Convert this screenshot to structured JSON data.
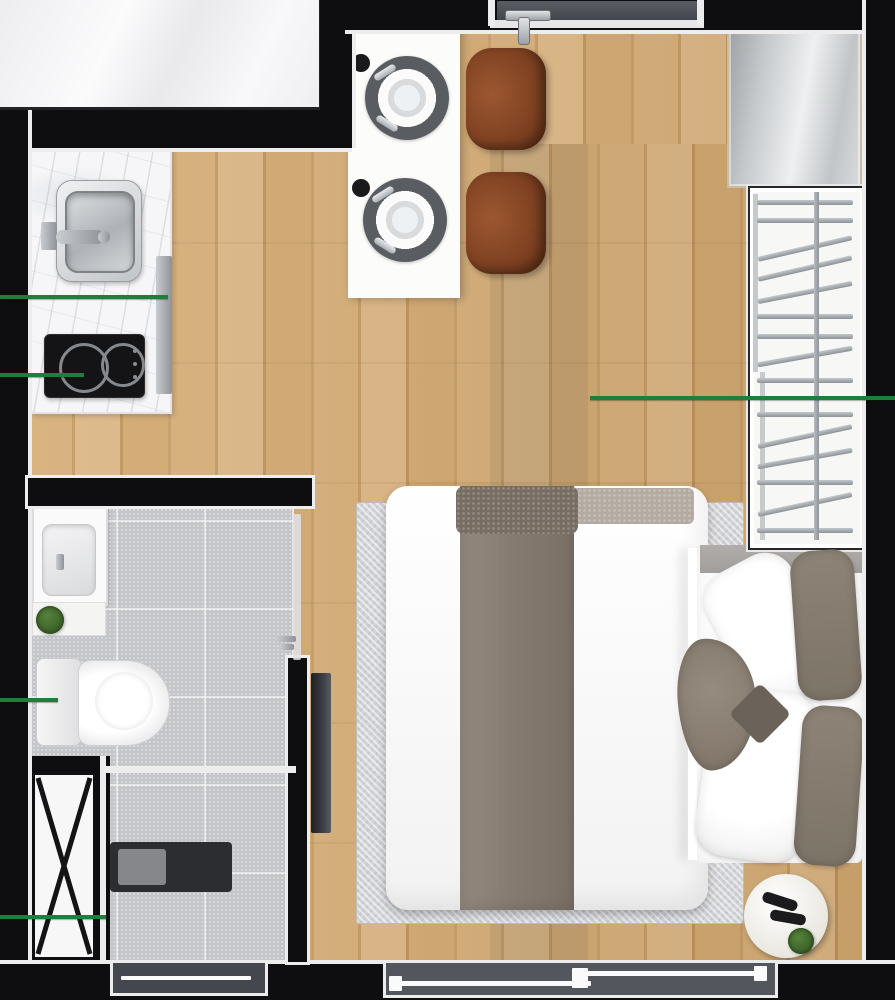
{
  "meta": {
    "type": "floor-plan-render",
    "view": "top-down",
    "canvas_w": 895,
    "canvas_h": 1000
  },
  "colors": {
    "wall": "#0e0e10",
    "wallLine": "#ededed",
    "outsideEdge": "#232327",
    "woodA": "#d6ae78",
    "woodB": "#c59a62",
    "woodC": "#dcb684",
    "woodD": "#c09358",
    "tile": "#c4c5c9",
    "marble": "#f6f6f8",
    "cooktop": "#141416",
    "chair": "#7e4122",
    "tableTop": "#fcfcfa",
    "rug": "#d2d3d7",
    "blanket": "#857a6f",
    "blanketFold": "#776d63",
    "pillowTaupe": "#7d7468",
    "tv": "#3c3f45",
    "doorSlab": "#42464c",
    "glass": "#53575d",
    "glassDark": "#44484e",
    "ductFace": "#f7f7f7",
    "plant": "#2f541f",
    "sideTable": "#e9e7e0",
    "dimLine": "#1f7d3e"
  },
  "rooms": [
    {
      "name": "kitchen",
      "fixtures": [
        "marble-countertop",
        "stainless-sink",
        "faucet",
        "induction-cooktop-2-burner",
        "steel-side-panel"
      ]
    },
    {
      "name": "dining",
      "fixtures": [
        "dining-table",
        "charger-plate",
        "charger-plate",
        "cup",
        "cup",
        "chair",
        "chair"
      ]
    },
    {
      "name": "entry",
      "fixtures": [
        "entrance-door"
      ]
    },
    {
      "name": "living-sleeping",
      "fixtures": [
        "double-bed",
        "area-rug",
        "wall-tv",
        "wardrobe-closet",
        "tall-cabinet",
        "round-side-table",
        "slippers",
        "plant-pot"
      ]
    },
    {
      "name": "bathroom",
      "fixtures": [
        "vanity-sink",
        "plant-pot",
        "toilet",
        "glass-partition",
        "shower-mat",
        "duct-shaft",
        "window"
      ]
    }
  ],
  "doors": [
    {
      "id": "entrance-door",
      "wall": "top",
      "state": "closed"
    },
    {
      "id": "bathroom-door",
      "wall": "interior",
      "state": "open"
    }
  ],
  "windows": [
    {
      "id": "main-window",
      "wall": "bottom",
      "panes": 2
    },
    {
      "id": "bathroom-window",
      "wall": "bottom",
      "panes": 1
    }
  ],
  "dimension_lines": [
    {
      "x": 0,
      "y": 295,
      "length": 168
    },
    {
      "x": 0,
      "y": 373,
      "length": 84
    },
    {
      "x": 590,
      "y": 396,
      "length": 305
    },
    {
      "x": 0,
      "y": 698,
      "length": 58
    },
    {
      "x": 0,
      "y": 915,
      "length": 106
    }
  ],
  "closet": {
    "hangers": [
      {
        "dy": 12,
        "angle": 0
      },
      {
        "dy": 30,
        "angle": 0
      },
      {
        "dy": 58,
        "angle": -13
      },
      {
        "dy": 78,
        "angle": -13
      },
      {
        "dy": 102,
        "angle": -11
      },
      {
        "dy": 126,
        "angle": 0
      },
      {
        "dy": 146,
        "angle": 0
      },
      {
        "dy": 166,
        "angle": -10
      },
      {
        "dy": 190,
        "angle": 0
      },
      {
        "dy": 224,
        "angle": 0
      },
      {
        "dy": 246,
        "angle": -12
      },
      {
        "dy": 268,
        "angle": -10
      },
      {
        "dy": 292,
        "angle": 0
      },
      {
        "dy": 314,
        "angle": -12
      },
      {
        "dy": 340,
        "angle": 0
      }
    ]
  }
}
